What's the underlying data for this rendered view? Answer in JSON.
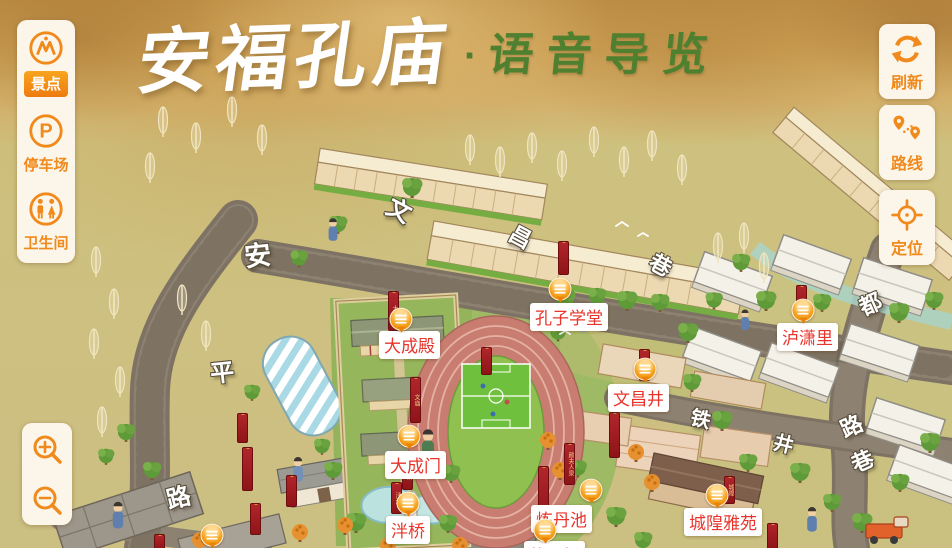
{
  "title": {
    "main": "安福孔庙",
    "dot": "·",
    "sub": "语音导览"
  },
  "colors": {
    "accent_orange": "#f08a1c",
    "poi_text_red": "#e8342b",
    "title_green": "#4f8030",
    "banner_red": "#a32126",
    "panel_bg": "#fcf6ea"
  },
  "left_toolbar": {
    "items": [
      {
        "id": "scenic",
        "label": "景点",
        "icon": "scenic-spots-icon",
        "active": true
      },
      {
        "id": "parking",
        "label": "停车场",
        "icon": "parking-icon",
        "active": false
      },
      {
        "id": "restroom",
        "label": "卫生间",
        "icon": "restroom-icon",
        "active": false
      }
    ]
  },
  "right_toolbar": {
    "items": [
      {
        "id": "refresh",
        "label": "刷新",
        "icon": "refresh-icon"
      },
      {
        "id": "route",
        "label": "路线",
        "icon": "route-icon"
      },
      {
        "id": "locate",
        "label": "定位",
        "icon": "locate-icon"
      }
    ]
  },
  "zoom_controls": {
    "items": [
      {
        "id": "zoom-in",
        "icon": "zoom-in-icon"
      },
      {
        "id": "zoom-out",
        "icon": "zoom-out-icon"
      }
    ]
  },
  "map": {
    "poi": [
      {
        "name": "大成殿",
        "label_x": 379,
        "label_y": 331,
        "marker_x": 401,
        "marker_y": 321
      },
      {
        "name": "孔子学堂",
        "label_x": 530,
        "label_y": 303,
        "marker_x": 560,
        "marker_y": 291
      },
      {
        "name": "泸潇里",
        "label_x": 777,
        "label_y": 323,
        "marker_x": 803,
        "marker_y": 312
      },
      {
        "name": "文昌井",
        "label_x": 608,
        "label_y": 384,
        "marker_x": 645,
        "marker_y": 371
      },
      {
        "name": "大成门",
        "label_x": 385,
        "label_y": 451,
        "marker_x": 409,
        "marker_y": 438
      },
      {
        "name": "泮桥",
        "label_x": 386,
        "label_y": 516,
        "marker_x": 408,
        "marker_y": 505
      },
      {
        "name": "炼丹池",
        "label_x": 531,
        "label_y": 505,
        "marker_x": 591,
        "marker_y": 492
      },
      {
        "name": "城隍雅苑",
        "label_x": 684,
        "label_y": 508,
        "marker_x": 717,
        "marker_y": 497
      },
      {
        "name": "状元桥",
        "label_x": 524,
        "label_y": 541,
        "marker_x": 545,
        "marker_y": 532
      }
    ],
    "lone_markers": [
      {
        "x": 212,
        "y": 537
      }
    ],
    "street_names": [
      {
        "char": "安",
        "x": 244,
        "y": 234,
        "rot": -6,
        "size": 27
      },
      {
        "char": "平",
        "x": 210,
        "y": 353,
        "rot": -6,
        "size": 24
      },
      {
        "char": "路",
        "x": 166,
        "y": 478,
        "rot": -14,
        "size": 24
      },
      {
        "char": "文",
        "x": 388,
        "y": 191,
        "rot": 28,
        "size": 24
      },
      {
        "char": "昌",
        "x": 510,
        "y": 220,
        "rot": 28,
        "size": 22
      },
      {
        "char": "巷",
        "x": 650,
        "y": 248,
        "rot": 28,
        "size": 22
      },
      {
        "char": "铁",
        "x": 691,
        "y": 403,
        "rot": 14,
        "size": 20
      },
      {
        "char": "井",
        "x": 774,
        "y": 428,
        "rot": 14,
        "size": 20
      },
      {
        "char": "都",
        "x": 859,
        "y": 287,
        "rot": -24,
        "size": 22
      },
      {
        "char": "路",
        "x": 840,
        "y": 409,
        "rot": -24,
        "size": 22
      },
      {
        "char": "巷",
        "x": 851,
        "y": 444,
        "rot": -24,
        "size": 22
      }
    ],
    "banners": [
      {
        "x": 388,
        "y": 291,
        "h": 38,
        "text": "大成"
      },
      {
        "x": 410,
        "y": 377,
        "h": 44,
        "text": "文庙"
      },
      {
        "x": 481,
        "y": 347,
        "h": 26,
        "text": ""
      },
      {
        "x": 558,
        "y": 241,
        "h": 32,
        "text": ""
      },
      {
        "x": 639,
        "y": 349,
        "h": 30,
        "text": "文昌"
      },
      {
        "x": 796,
        "y": 285,
        "h": 28,
        "text": ""
      },
      {
        "x": 242,
        "y": 447,
        "h": 42,
        "text": ""
      },
      {
        "x": 402,
        "y": 458,
        "h": 30,
        "text": "泮桥"
      },
      {
        "x": 391,
        "y": 482,
        "h": 30,
        "text": "泮池"
      },
      {
        "x": 538,
        "y": 466,
        "h": 62,
        "text": ""
      },
      {
        "x": 564,
        "y": 443,
        "h": 40,
        "text": "颜夫人泉"
      },
      {
        "x": 609,
        "y": 412,
        "h": 44,
        "text": ""
      },
      {
        "x": 724,
        "y": 476,
        "h": 26,
        "text": "城隍"
      },
      {
        "x": 767,
        "y": 523,
        "h": 25,
        "text": ""
      },
      {
        "x": 55,
        "y": 474,
        "h": 38,
        "text": ""
      },
      {
        "x": 250,
        "y": 503,
        "h": 30,
        "text": ""
      },
      {
        "x": 154,
        "y": 534,
        "h": 14,
        "text": ""
      },
      {
        "x": 286,
        "y": 475,
        "h": 30,
        "text": ""
      },
      {
        "x": 237,
        "y": 413,
        "h": 28,
        "text": ""
      }
    ]
  }
}
